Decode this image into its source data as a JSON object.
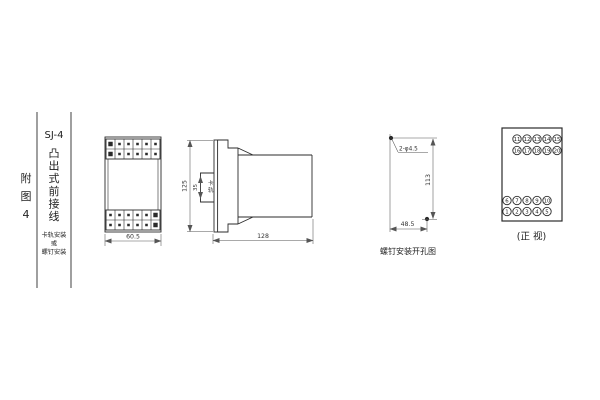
{
  "canvas": {
    "background": "#ffffff",
    "ink_color": "#2b2b2b"
  },
  "title_block": {
    "figure_chars": [
      "附",
      "图",
      "4"
    ],
    "model": "SJ-4",
    "type_chars": [
      "凸",
      "出",
      "式",
      "前",
      "接",
      "线"
    ],
    "mount_lines": [
      "卡轨安装",
      "或",
      "螺钉安装"
    ]
  },
  "front_view": {
    "width_dim": "60.5"
  },
  "side_view": {
    "height_dim": "125",
    "clip_dim": "35",
    "clip_label_chars": [
      "卡",
      "轨"
    ],
    "depth_dim": "128"
  },
  "drill_view": {
    "holes_label": "2-φ4.5",
    "vertical_dim": "113",
    "horizontal_dim": "48.5",
    "caption": "螺钉安装开孔图"
  },
  "terminal_view": {
    "rows": [
      [
        "11",
        "12",
        "13",
        "14",
        "15"
      ],
      [
        "16",
        "17",
        "18",
        "19",
        "20"
      ],
      [
        "6",
        "7",
        "8",
        "9",
        "10"
      ],
      [
        "1",
        "2",
        "3",
        "4",
        "5"
      ]
    ],
    "caption": "(正 视)"
  }
}
